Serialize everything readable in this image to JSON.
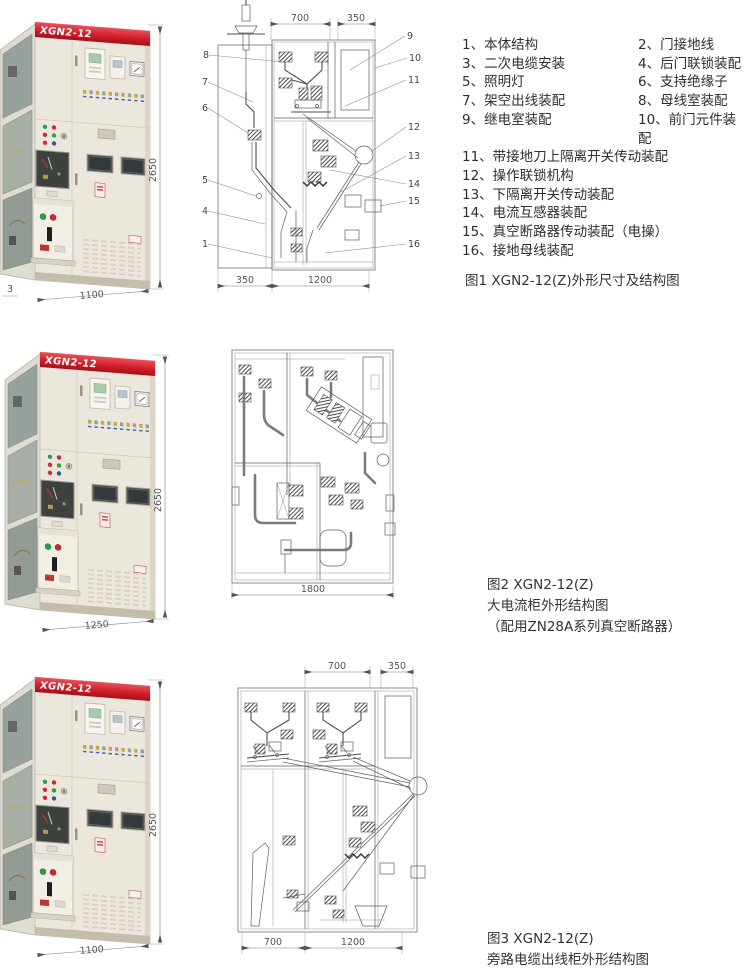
{
  "page": {
    "background": "#ffffff",
    "accent_red": "#c8202d",
    "drawing_line_color": "#5f5f5f"
  },
  "parts_list": [
    "1、本体结构",
    "2、门接地线",
    "3、二次电缆安装",
    "4、后门联锁装配",
    "5、照明灯",
    "6、支持绝缘子",
    "7、架空出线装配",
    "8、母线室装配",
    "9、继电室装配",
    "10、前门元件装配",
    "11、带接地刀上隔离开关传动装配",
    "12、操作联锁机构",
    "13、下隔离开关传动装配",
    "14、电流互感器装配",
    "15、真空断路器传动装配（电操）",
    "16、接地母线装配"
  ],
  "figures": [
    {
      "photo": {
        "model": "XGN2-12",
        "height_dim": "2650",
        "width_dim": "1100",
        "side_callout": "3"
      },
      "drawing": {
        "top_dims": [
          "700",
          "350"
        ],
        "bottom_dims": [
          "350",
          "1200"
        ],
        "callouts_left": [
          "8",
          "7",
          "6",
          "5",
          "4",
          "1"
        ],
        "callouts_right": [
          "9",
          "10",
          "11",
          "12",
          "13",
          "14",
          "15",
          "16"
        ]
      },
      "caption": "图1 XGN2-12(Z)外形尺寸及结构图"
    },
    {
      "photo": {
        "model": "XGN2-12",
        "height_dim": "2650",
        "width_dim": "1250"
      },
      "drawing": {
        "bottom_dims": [
          "1800"
        ]
      },
      "caption_lines": [
        "图2 XGN2-12(Z)",
        "大电流柜外形结构图",
        "（配用ZN28A系列真空断路器）"
      ]
    },
    {
      "photo": {
        "model": "XGN2-12",
        "height_dim": "2650",
        "width_dim": "1100"
      },
      "drawing": {
        "top_dims": [
          "700",
          "350"
        ],
        "bottom_dims": [
          "700",
          "1200"
        ]
      },
      "caption_lines": [
        "图3 XGN2-12(Z)",
        "旁路电缆出线柜外形结构图"
      ]
    }
  ]
}
